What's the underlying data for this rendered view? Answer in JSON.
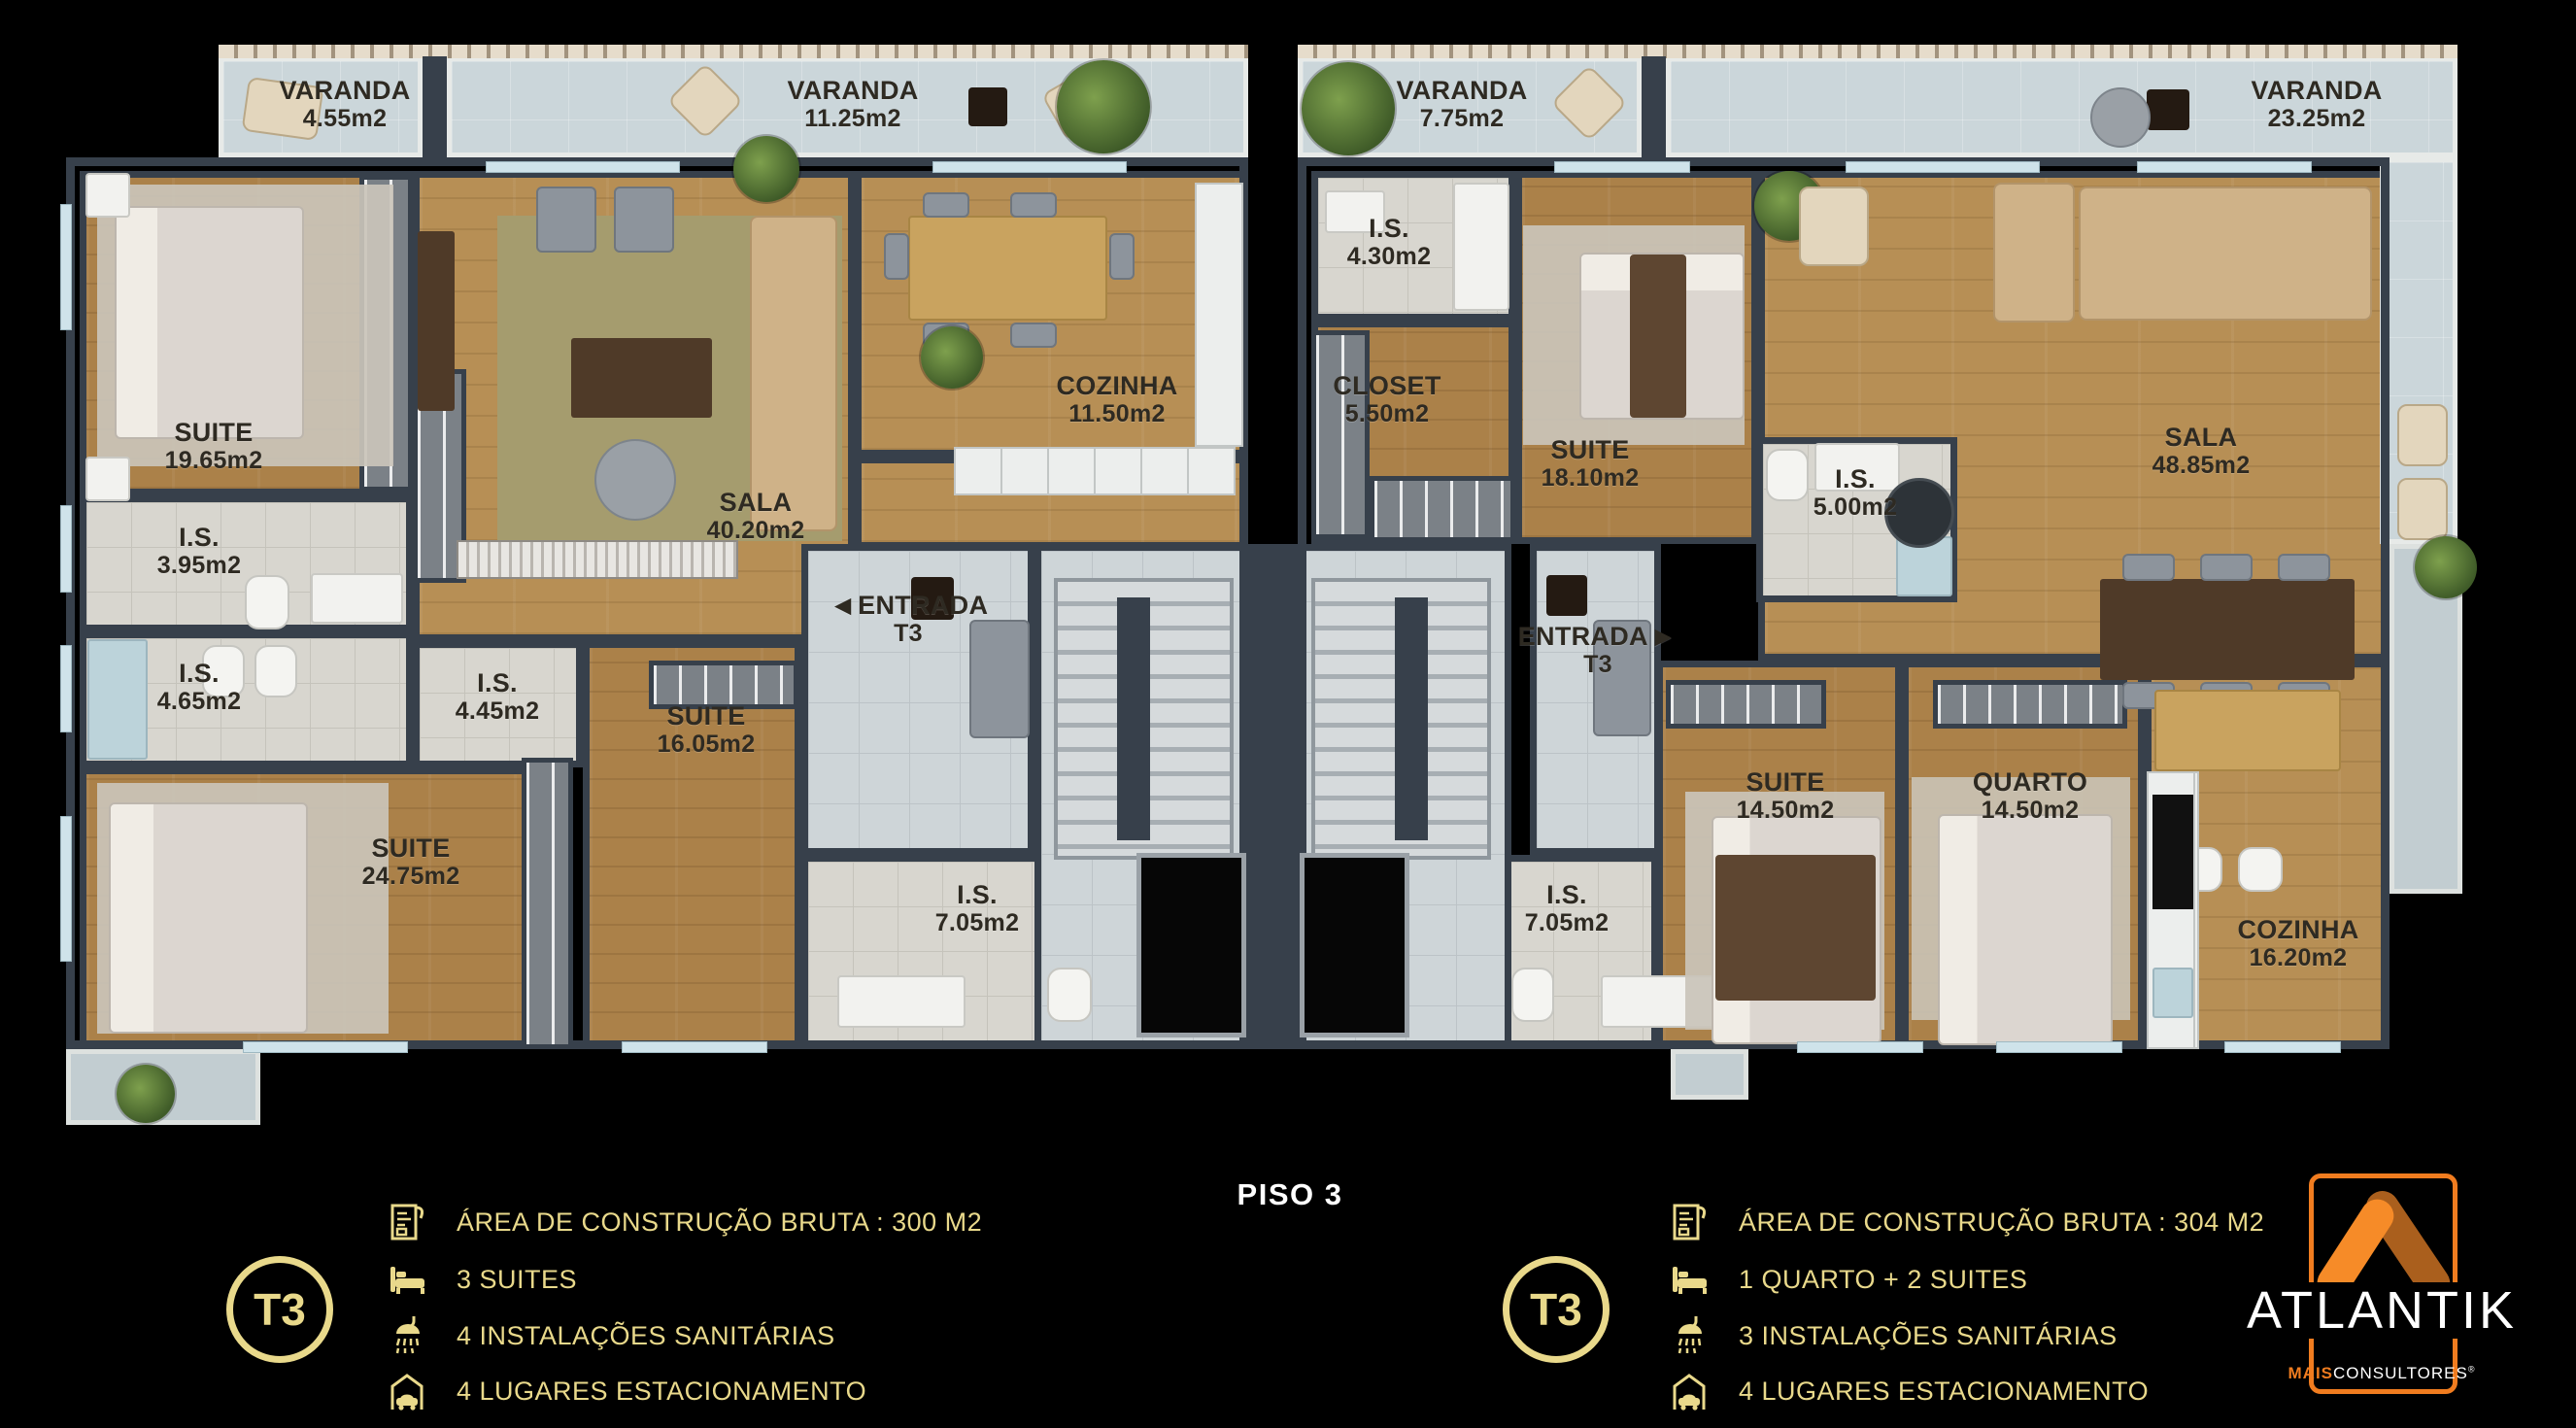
{
  "title": "PISO 3",
  "colors": {
    "background": "#000000",
    "gold": "#e9d98b",
    "logo_orange": "#f07c1f",
    "logo_orange_dark": "#aa5f1d",
    "wall": "#37404b",
    "wood_floor": "#ab8149",
    "balcony": "#cbd6da",
    "tile": "#d8d6cf"
  },
  "plan": {
    "varanda_455": {
      "label": "VARANDA",
      "area": "4.55m2"
    },
    "varanda_1125": {
      "label": "VARANDA",
      "area": "11.25m2"
    },
    "varanda_775": {
      "label": "VARANDA",
      "area": "7.75m2"
    },
    "varanda_2325": {
      "label": "VARANDA",
      "area": "23.25m2"
    },
    "suite_1965": {
      "label": "SUITE",
      "area": "19.65m2"
    },
    "is_395": {
      "label": "I.S.",
      "area": "3.95m2"
    },
    "is_465": {
      "label": "I.S.",
      "area": "4.65m2"
    },
    "suite_2475": {
      "label": "SUITE",
      "area": "24.75m2"
    },
    "is_445": {
      "label": "I.S.",
      "area": "4.45m2"
    },
    "suite_1605": {
      "label": "SUITE",
      "area": "16.05m2"
    },
    "sala_4020": {
      "label": "SALA",
      "area": "40.20m2"
    },
    "cozinha_1150": {
      "label": "COZINHA",
      "area": "11.50m2"
    },
    "entrada_left": {
      "label": "ENTRADA",
      "area": "T3",
      "arrow": "◀"
    },
    "is_705_left": {
      "label": "I.S.",
      "area": "7.05m2"
    },
    "is_430": {
      "label": "I.S.",
      "area": "4.30m2"
    },
    "closet_550": {
      "label": "CLOSET",
      "area": "5.50m2"
    },
    "suite_1810": {
      "label": "SUITE",
      "area": "18.10m2"
    },
    "is_500": {
      "label": "I.S.",
      "area": "5.00m2"
    },
    "sala_4885": {
      "label": "SALA",
      "area": "48.85m2"
    },
    "entrada_right": {
      "label": "ENTRADA",
      "area": "T3",
      "arrow": "▶"
    },
    "is_705_right": {
      "label": "I.S.",
      "area": "7.05m2"
    },
    "suite_1450": {
      "label": "SUITE",
      "area": "14.50m2"
    },
    "quarto_1450": {
      "label": "QUARTO",
      "area": "14.50m2"
    },
    "cozinha_1620": {
      "label": "COZINHA",
      "area": "16.20m2"
    }
  },
  "legend_left": {
    "badge": "T3",
    "items": [
      {
        "icon": "floor-plan-icon",
        "text": "ÁREA DE CONSTRUÇÃO BRUTA :  300 M2"
      },
      {
        "icon": "bed-icon",
        "text": "3 SUITES"
      },
      {
        "icon": "shower-icon",
        "text": "4 INSTALAÇÕES SANITÁRIAS"
      },
      {
        "icon": "car-garage-icon",
        "text": "4 LUGARES ESTACIONAMENTO"
      }
    ]
  },
  "legend_right": {
    "badge": "T3",
    "items": [
      {
        "icon": "floor-plan-icon",
        "text": "ÁREA DE CONSTRUÇÃO BRUTA :  304 M2"
      },
      {
        "icon": "bed-icon",
        "text": "1 QUARTO + 2 SUITES"
      },
      {
        "icon": "shower-icon",
        "text": "3 INSTALAÇÕES SANITÁRIAS"
      },
      {
        "icon": "car-garage-icon",
        "text": "4 LUGARES ESTACIONAMENTO"
      }
    ]
  },
  "logo": {
    "brand": "ATLANTIK",
    "tag_bold": "MAIS",
    "tag": "CONSULTORES",
    "reg": "®"
  }
}
